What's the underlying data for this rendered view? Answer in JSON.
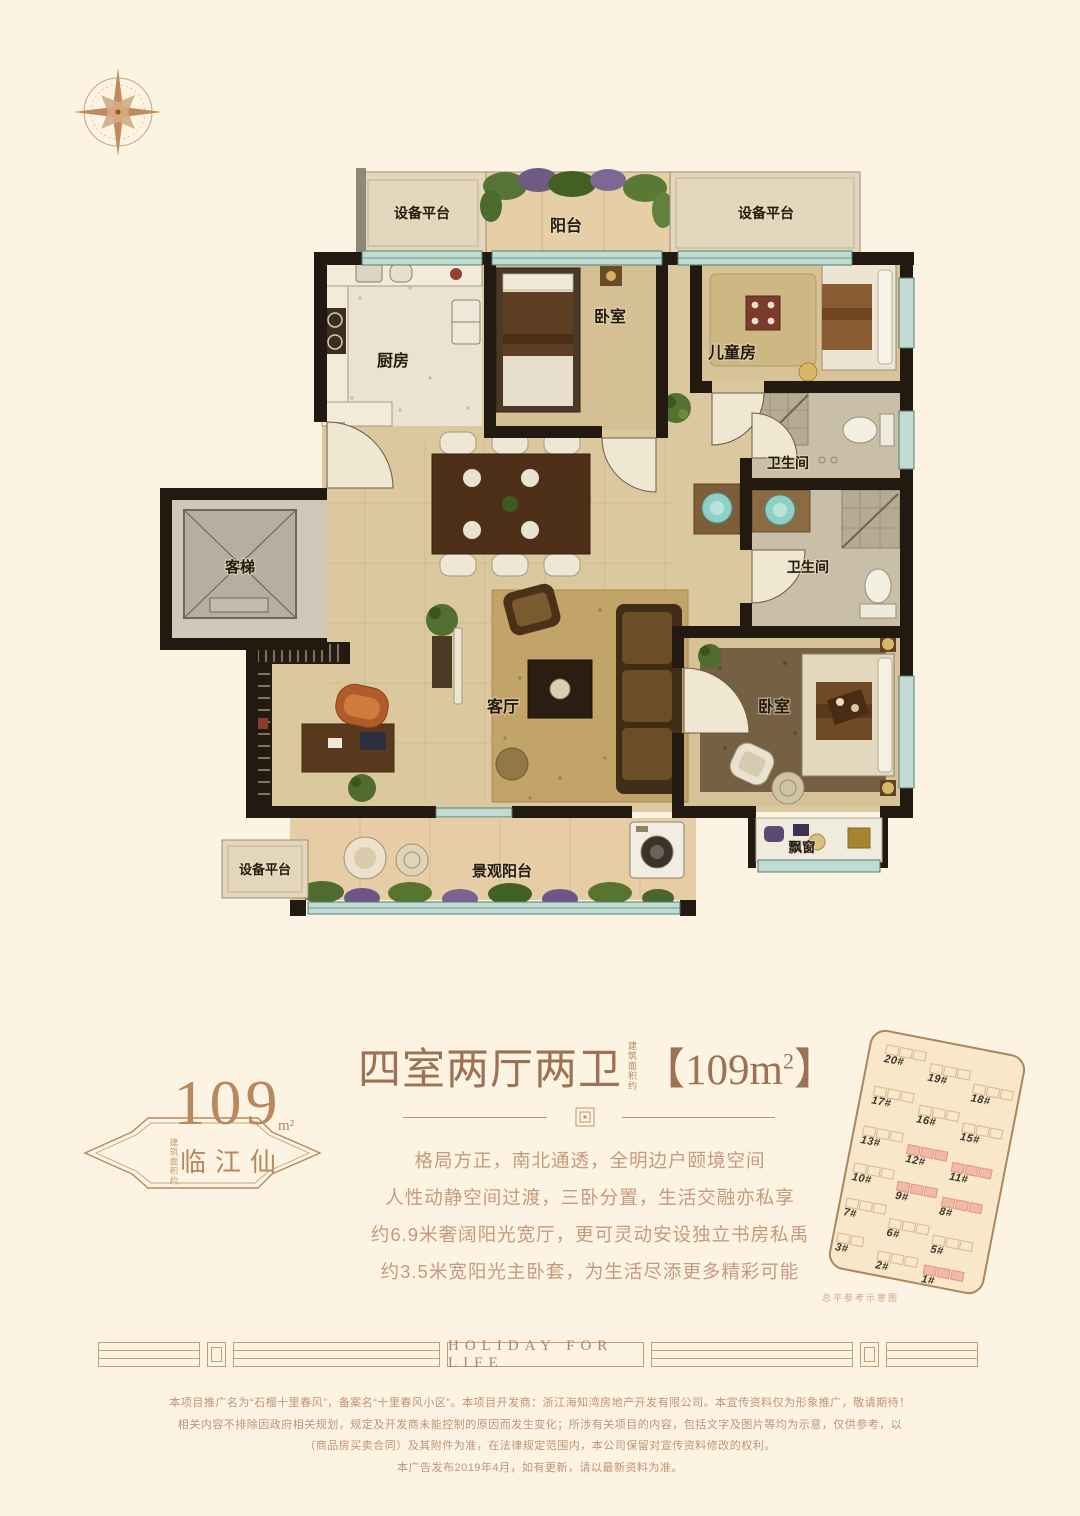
{
  "colors": {
    "background": "#fdf3e2",
    "title_text": "#9d7153",
    "body_text": "#c79a7e",
    "badge_text": "#b9885e",
    "wall": "#221a10",
    "window_teal": "#c2dcd3",
    "highlight_pink": "#f3b9a6",
    "divider_line": "#c49d79",
    "floor_tan": "#dcc89f"
  },
  "icons": {
    "compass": "compass-rose-icon",
    "divider_ornament": "square-knot-icon"
  },
  "floor_plan": {
    "labels": {
      "platform_top_left": "设备平台",
      "balcony_top": "阳台",
      "platform_top_right": "设备平台",
      "kitchen": "厨房",
      "bedroom_top": "卧室",
      "kids_room": "儿童房",
      "bathroom_upper": "卫生间",
      "elevator": "客梯",
      "bathroom_lower": "卫生间",
      "living_room": "客厅",
      "master_bedroom": "卧室",
      "bay_window": "飘窗",
      "platform_bottom_left": "设备平台",
      "view_balcony": "景观阳台"
    }
  },
  "info_section": {
    "badge": {
      "number": "109",
      "unit": "m²",
      "name": "临江仙",
      "vertical_note": "建筑面积约"
    },
    "title": {
      "main": "四室两厅两卫",
      "vertical_note": "建筑面积约",
      "area_pre": "【109m",
      "area_sup": "2",
      "area_post": "】"
    },
    "description_lines": [
      "格局方正，南北通透，全明边户颐境空间",
      "人性动静空间过渡，三卧分置，生活交融亦私享",
      "约6.9米奢阔阳光宽厅，更可灵动安设独立书房私禹",
      "约3.5米宽阳光主卧套，为生活尽添更多精彩可能"
    ]
  },
  "site_plan": {
    "caption": "总平参考示意图",
    "buildings": [
      {
        "label": "20#",
        "highlight": false
      },
      {
        "label": "19#",
        "highlight": false
      },
      {
        "label": "18#",
        "highlight": false
      },
      {
        "label": "17#",
        "highlight": false
      },
      {
        "label": "16#",
        "highlight": false
      },
      {
        "label": "15#",
        "highlight": false
      },
      {
        "label": "13#",
        "highlight": false
      },
      {
        "label": "12#",
        "highlight": true
      },
      {
        "label": "11#",
        "highlight": true
      },
      {
        "label": "10#",
        "highlight": false
      },
      {
        "label": "9#",
        "highlight": true
      },
      {
        "label": "8#",
        "highlight": true
      },
      {
        "label": "7#",
        "highlight": false
      },
      {
        "label": "6#",
        "highlight": false
      },
      {
        "label": "5#",
        "highlight": false
      },
      {
        "label": "3#",
        "highlight": false
      },
      {
        "label": "2#",
        "highlight": false
      },
      {
        "label": "1#",
        "highlight": true
      }
    ]
  },
  "banner": {
    "text": "HOLIDAY FOR LIFE"
  },
  "disclaimer_lines": [
    "本项目推广名为“石榴十里春风”，备案名“十里春风小区”。本项目开发商：浙江海知湾房地产开发有限公司。本宣传资料仅为形象推广，敬请期待！",
    "相关内容不排除因政府相关规划，规定及开发商未能控制的原因而发生变化；所涉有关项目的内容，包括文字及图片等均为示意，仅供参考，以",
    "（商品房买卖合同）及其附件为准，在法律规定范围内，本公司保留对宣传资料修改的权利。",
    "本广告发布2019年4月，如有更新，请以最新资料为准。"
  ]
}
